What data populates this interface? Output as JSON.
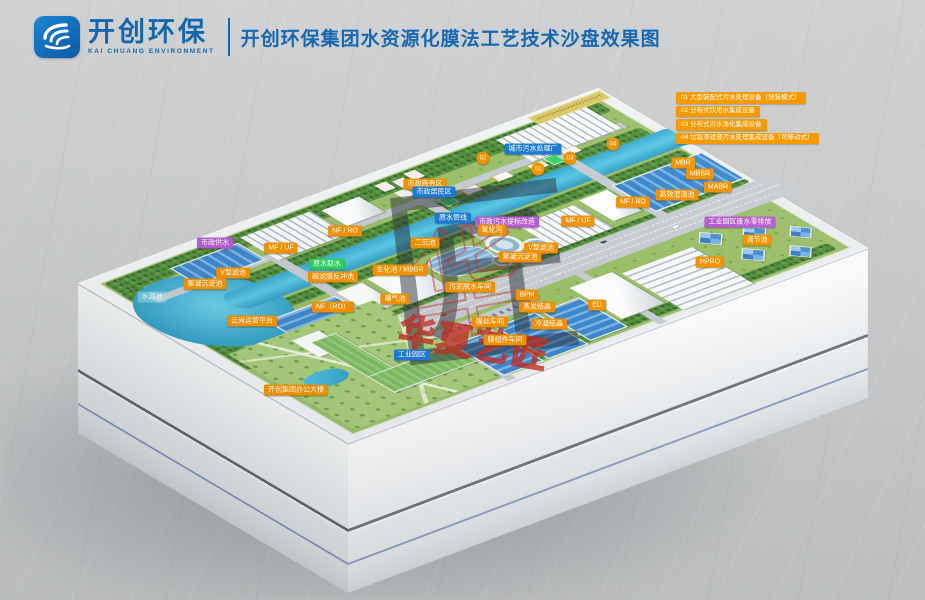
{
  "header": {
    "logo_text": "开创环保",
    "logo_sub": "KAI CHUANG ENVIRONMENT",
    "title": "开创环保集团水资源化膜法工艺技术沙盘效果图"
  },
  "legend": {
    "items": [
      "01 大型装配式污水处理设备（快装模式）",
      "02 分布式饮用水集成设备",
      "03 分布式污水净化集成设备",
      "04 垃圾渗滤液污水处理集成设备（可移动式）"
    ]
  },
  "watermark": {
    "glyph": "匠",
    "red_glyph": "华",
    "brand": "华夏艺匠"
  },
  "colors": {
    "accent_blue": "#1467ad",
    "label_orange": "#f39200",
    "label_blue": "#1e7ad4",
    "label_purple": "#b65bd3",
    "label_green": "#2ecc5e",
    "water": "#45b6dc",
    "land_green": "#9cbf6b"
  },
  "map_labels": [
    {
      "text": "市政供水",
      "x": 215,
      "y": 243,
      "type": "purple"
    },
    {
      "text": "MF / UF",
      "x": 281,
      "y": 248,
      "type": "orange"
    },
    {
      "text": "NF / RO",
      "x": 345,
      "y": 231,
      "type": "orange"
    },
    {
      "text": "V型滤池",
      "x": 233,
      "y": 273,
      "type": "orange"
    },
    {
      "text": "絮凝沉淀池",
      "x": 205,
      "y": 284,
      "type": "orange"
    },
    {
      "text": "原水取水",
      "x": 327,
      "y": 264,
      "type": "green"
    },
    {
      "text": "超滤膜反冲洗",
      "x": 333,
      "y": 277,
      "type": "orange"
    },
    {
      "text": "曝气池",
      "x": 395,
      "y": 299,
      "type": "orange"
    },
    {
      "text": "NF（RO）",
      "x": 333,
      "y": 307,
      "type": "orange"
    },
    {
      "text": "云尚运营平台",
      "x": 252,
      "y": 321,
      "type": "orange"
    },
    {
      "text": "开创集团办公大楼",
      "x": 296,
      "y": 390,
      "type": "orange"
    },
    {
      "text": "水源地",
      "x": 152,
      "y": 297,
      "type": "cyan"
    },
    {
      "text": "市政商务区",
      "x": 425,
      "y": 184,
      "type": "orange"
    },
    {
      "text": "市政居民区",
      "x": 434,
      "y": 192,
      "type": "blue"
    },
    {
      "text": "原水管线",
      "x": 453,
      "y": 218,
      "type": "blue"
    },
    {
      "text": "市政污水提标改造",
      "x": 507,
      "y": 222,
      "type": "purple"
    },
    {
      "text": "氧化沟",
      "x": 492,
      "y": 230,
      "type": "orange"
    },
    {
      "text": "二沉池",
      "x": 425,
      "y": 243,
      "type": "orange"
    },
    {
      "text": "生化池 / MBBR",
      "x": 400,
      "y": 270,
      "type": "orange"
    },
    {
      "text": "污泥脱水车间",
      "x": 470,
      "y": 287,
      "type": "orange"
    },
    {
      "text": "工业园区",
      "x": 412,
      "y": 355,
      "type": "blue"
    },
    {
      "text": "城市污水处理厂",
      "x": 533,
      "y": 149,
      "type": "blue"
    },
    {
      "text": "V型滤池",
      "x": 541,
      "y": 248,
      "type": "orange"
    },
    {
      "text": "絮凝沉淀池",
      "x": 520,
      "y": 257,
      "type": "orange"
    },
    {
      "text": "MF / UF",
      "x": 578,
      "y": 221,
      "type": "orange"
    },
    {
      "text": "NF / RO",
      "x": 633,
      "y": 202,
      "type": "orange"
    },
    {
      "text": "高效澄清池",
      "x": 677,
      "y": 195,
      "type": "orange"
    },
    {
      "text": "MBR",
      "x": 683,
      "y": 163,
      "type": "orange"
    },
    {
      "text": "MBBR",
      "x": 700,
      "y": 174,
      "type": "orange"
    },
    {
      "text": "MABR",
      "x": 718,
      "y": 187,
      "type": "orange"
    },
    {
      "text": "工业园区废水零排放",
      "x": 740,
      "y": 222,
      "type": "purple"
    },
    {
      "text": "调节池",
      "x": 757,
      "y": 240,
      "type": "orange"
    },
    {
      "text": "HPRO",
      "x": 710,
      "y": 262,
      "type": "orange"
    },
    {
      "text": "BPM",
      "x": 527,
      "y": 295,
      "type": "orange"
    },
    {
      "text": "蒸发结晶",
      "x": 537,
      "y": 307,
      "type": "orange"
    },
    {
      "text": "ED",
      "x": 597,
      "y": 305,
      "type": "orange"
    },
    {
      "text": "冷凝结晶",
      "x": 549,
      "y": 324,
      "type": "orange"
    },
    {
      "text": "膜丝车间",
      "x": 490,
      "y": 322,
      "type": "orange"
    },
    {
      "text": "膜组件车间",
      "x": 505,
      "y": 340,
      "type": "orange"
    },
    {
      "text": "01",
      "x": 538,
      "y": 169,
      "type": "circle"
    },
    {
      "text": "02",
      "x": 483,
      "y": 158,
      "type": "circle"
    },
    {
      "text": "03",
      "x": 570,
      "y": 158,
      "type": "circle"
    },
    {
      "text": "04",
      "x": 613,
      "y": 144,
      "type": "circle"
    }
  ]
}
